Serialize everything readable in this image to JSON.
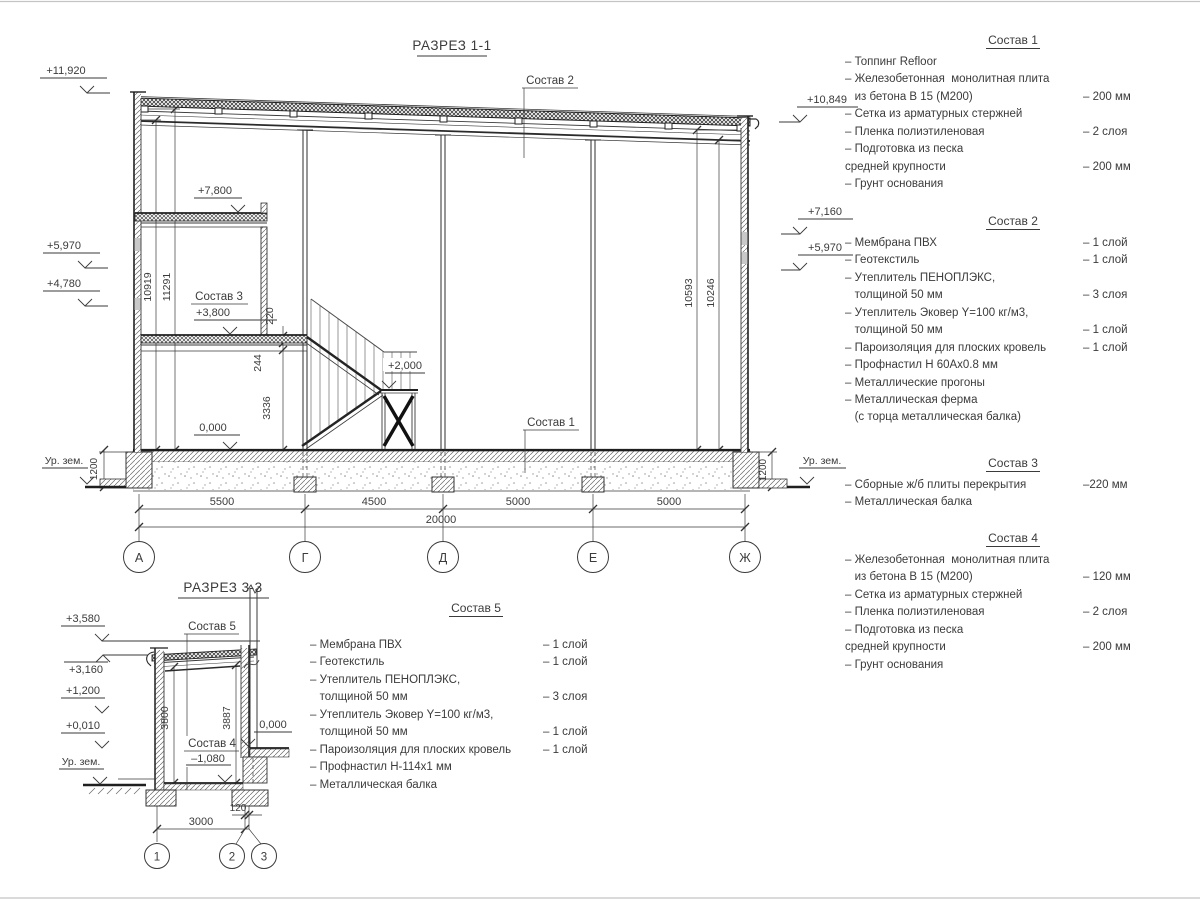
{
  "page": {
    "background": "#ffffff",
    "line_color": "#3a3a3a"
  },
  "s1": {
    "title": "РАЗРЕЗ 1-1",
    "labels": {
      "sostav1": "Состав 1",
      "sostav2": "Состав 2",
      "sostav3": "Состав 3"
    },
    "elev": {
      "e11920": "+11,920",
      "e5970l": "+5,970",
      "e4780": "+4,780",
      "e10849": "+10,849",
      "e7160": "+7,160",
      "e5970r": "+5,970",
      "e7800": "+7,800",
      "e3800": "+3,800",
      "e2000": "+2,000",
      "e0000": "0,000",
      "ur_zem_l": "Ур. зем.",
      "ur_zem_r": "Ур. зем."
    },
    "vdims": {
      "d10919": "10919",
      "d11291": "11291",
      "d10593": "10593",
      "d10246": "10246",
      "d220": "220",
      "d244": "244",
      "d3336": "3336",
      "d1200l": "1200",
      "d1200r": "1200"
    },
    "hdims": {
      "d5500": "5500",
      "d4500": "4500",
      "d5000a": "5000",
      "d5000b": "5000",
      "d20000": "20000"
    },
    "axes": [
      "А",
      "Г",
      "Д",
      "Е",
      "Ж"
    ]
  },
  "s3": {
    "title": "РАЗРЕЗ 3-3",
    "labels": {
      "sostav5": "Состав 5",
      "sostav4": "Состав 4"
    },
    "elev": {
      "e3580": "+3,580",
      "e3160": "+3,160",
      "e1200": "+1,200",
      "e0010": "+0,010",
      "ur_zem": "Ур. зем.",
      "em1080": "–1,080",
      "e0000": "0,000"
    },
    "vdims": {
      "d3800": "3800",
      "d3887": "3887"
    },
    "hdims": {
      "d120": "120",
      "d3000": "3000"
    },
    "axes": [
      "1",
      "2",
      "3"
    ]
  },
  "compositions": [
    {
      "title": "Состав 1",
      "items": [
        [
          "– Топпинг Refloor",
          ""
        ],
        [
          "– Железобетонная  монолитная плита",
          ""
        ],
        [
          "   из бетона В 15 (М200)",
          "– 200 мм"
        ],
        [
          "– Сетка из арматурных стержней",
          ""
        ],
        [
          "– Пленка полиэтиленовая",
          "– 2 слоя"
        ],
        [
          "– Подготовка из песка",
          ""
        ],
        [
          "средней крупности",
          "– 200 мм"
        ],
        [
          "– Грунт основания",
          ""
        ]
      ]
    },
    {
      "title": "Состав 2",
      "items": [
        [
          "– Мембрана ПВХ",
          "– 1 слой"
        ],
        [
          "– Геотекстиль",
          "– 1 слой"
        ],
        [
          "– Утеплитель ПЕНОПЛЭКС,",
          ""
        ],
        [
          "   толщиной 50 мм",
          "– 3 слоя"
        ],
        [
          "– Утеплитель Эковер Y=100 кг/м3,",
          ""
        ],
        [
          "   толщиной 50 мм",
          "– 1 слой"
        ],
        [
          "– Пароизоляция для плоских кровель",
          "– 1 слой"
        ],
        [
          "– Профнастил Н 60Ах0.8 мм",
          ""
        ],
        [
          "– Металлические прогоны",
          ""
        ],
        [
          "– Металлическая ферма",
          ""
        ],
        [
          "   (с торца металлическая балка)",
          ""
        ]
      ]
    },
    {
      "title": "Состав 3",
      "items": [
        [
          "– Сборные ж/б плиты перекрытия",
          "–220 мм"
        ],
        [
          "– Металлическая балка",
          ""
        ]
      ]
    },
    {
      "title": "Состав 4",
      "items": [
        [
          "– Железобетонная  монолитная плита",
          ""
        ],
        [
          "   из бетона В 15 (М200)",
          "– 120 мм"
        ],
        [
          "– Сетка из арматурных стержней",
          ""
        ],
        [
          "– Пленка полиэтиленовая",
          "– 2 слоя"
        ],
        [
          "– Подготовка из песка",
          ""
        ],
        [
          "средней крупности",
          "– 200 мм"
        ],
        [
          "– Грунт основания",
          ""
        ]
      ]
    },
    {
      "title": "Состав 5",
      "items": [
        [
          "– Мембрана ПВХ",
          "– 1 слой"
        ],
        [
          "– Геотекстиль",
          "– 1 слой"
        ],
        [
          "– Утеплитель ПЕНОПЛЭКС,",
          ""
        ],
        [
          "   толщиной 50 мм",
          "– 3 слоя"
        ],
        [
          "– Утеплитель Эковер Y=100 кг/м3,",
          ""
        ],
        [
          "   толщиной 50 мм",
          "– 1 слой"
        ],
        [
          "– Пароизоляция для плоских кровель",
          "– 1 слой"
        ],
        [
          "– Профнастил Н-114х1 мм",
          ""
        ],
        [
          "– Металлическая балка",
          ""
        ]
      ]
    }
  ]
}
